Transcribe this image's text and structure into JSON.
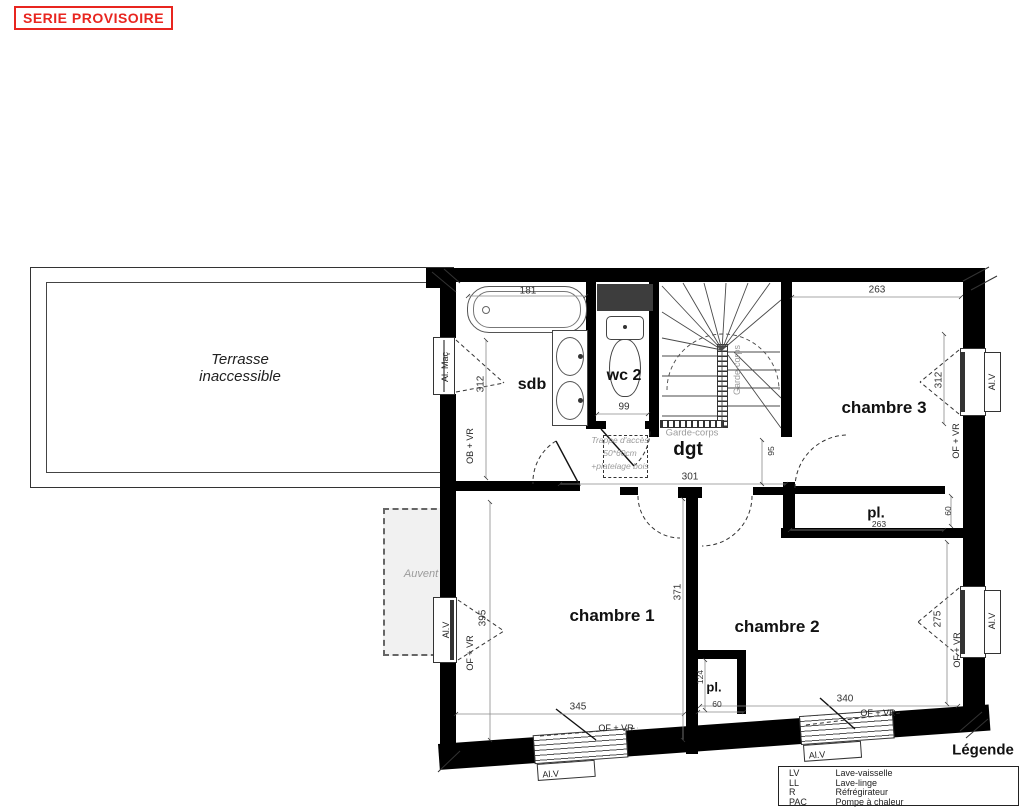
{
  "stamp": "SERIE PROVISOIRE",
  "colors": {
    "stamp_red": "#e8251f",
    "wall_black": "#000000",
    "duct_gray": "#3d3d3d",
    "annotation_gray": "#999999"
  },
  "rooms": {
    "terrasse_line1": "Terrasse",
    "terrasse_line2": "inaccessible",
    "auvent": "Auvent",
    "sdb": "sdb",
    "wc2": "wc 2",
    "dgt": "dgt",
    "chambre1": "chambre 1",
    "chambre2": "chambre 2",
    "chambre3": "chambre 3",
    "placard_ch3": "pl.",
    "placard_ch12": "pl."
  },
  "annotations": {
    "garde_corps_h": "Garde-corps",
    "garde_corps_v": "Garde-corps",
    "trappe_line1": "Trappe d'accès",
    "trappe_line2": "50*60cm",
    "trappe_line3": "+platelage bois"
  },
  "dims": {
    "bathtub": "181",
    "wc_width": "99",
    "ch3_top": "263",
    "sdb_window": "312",
    "ch3_window": "312",
    "dgt_width": "301",
    "dgt_depth": "95",
    "pl_ch3_width": "263",
    "pl_ch3_depth": "60",
    "ch1_depth": "371",
    "ch1_bottom": "345",
    "ch2_bottom": "340",
    "pl12_depth": "124",
    "pl12_width": "60",
    "ch1_window": "395",
    "ch2_window": "275"
  },
  "window_labels": {
    "al_mac": "Al. Maç",
    "ob_vr": "OB + VR",
    "of_vr": "OF + VR",
    "al_v": "Al.V"
  },
  "legend": {
    "title": "Légende",
    "rows": [
      {
        "abbr": "LV",
        "label": "Lave-vaisselle"
      },
      {
        "abbr": "LL",
        "label": "Lave-linge"
      },
      {
        "abbr": "R",
        "label": "Réfrégirateur"
      },
      {
        "abbr": "PAC",
        "label": "Pompe à chaleur"
      }
    ]
  }
}
